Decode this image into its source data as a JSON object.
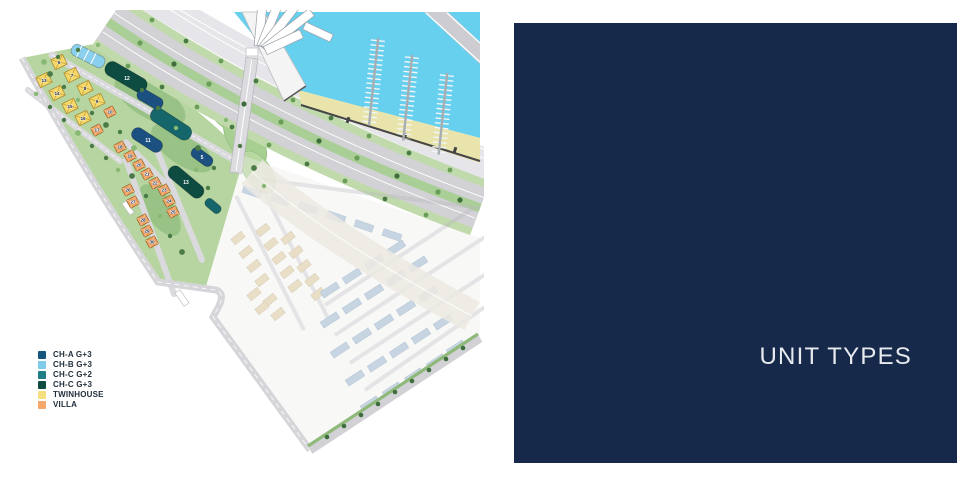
{
  "panel": {
    "title": "UNIT TYPES",
    "background": "#16294a",
    "text_color": "#e7eaee"
  },
  "legend": {
    "items": [
      {
        "label": "CH-A G+3",
        "color": "#15567d"
      },
      {
        "label": "CH-B G+3",
        "color": "#7fcbe9"
      },
      {
        "label": "CH-C G+2",
        "color": "#1f7d85"
      },
      {
        "label": "CH-C G+3",
        "color": "#0e4b41"
      },
      {
        "label": "TWINHOUSE",
        "color": "#f5df7e"
      },
      {
        "label": "VILLA",
        "color": "#f5a869"
      }
    ]
  },
  "map": {
    "twinhouse_units": [
      "6",
      "7",
      "8",
      "9",
      "13",
      "14",
      "15",
      "16"
    ],
    "villa_units": [
      "10",
      "17",
      "18",
      "19",
      "20",
      "21",
      "22",
      "23",
      "24",
      "25",
      "26",
      "27",
      "28",
      "29",
      "30"
    ],
    "apartment_labels": [
      "12",
      "11",
      "5",
      "13"
    ],
    "palette": {
      "water": "#67d0ee",
      "sand": "#e9e4ab",
      "road": "#d2d1d5",
      "median_green": "#a9cf97",
      "edge_green": "#c0daab",
      "parcel_green": "#b7d5a1",
      "platform": "#e6e5e9",
      "twinhouse": "#f4d86a",
      "villa": "#efa263",
      "ch_a": "#1c5080",
      "ch_c_g2": "#15666b",
      "ch_c_g3": "#0e4b41",
      "ch_b": "#8ad0ee",
      "faded_tan": "#d5c69b",
      "faded_blue": "#9db1c6"
    }
  }
}
